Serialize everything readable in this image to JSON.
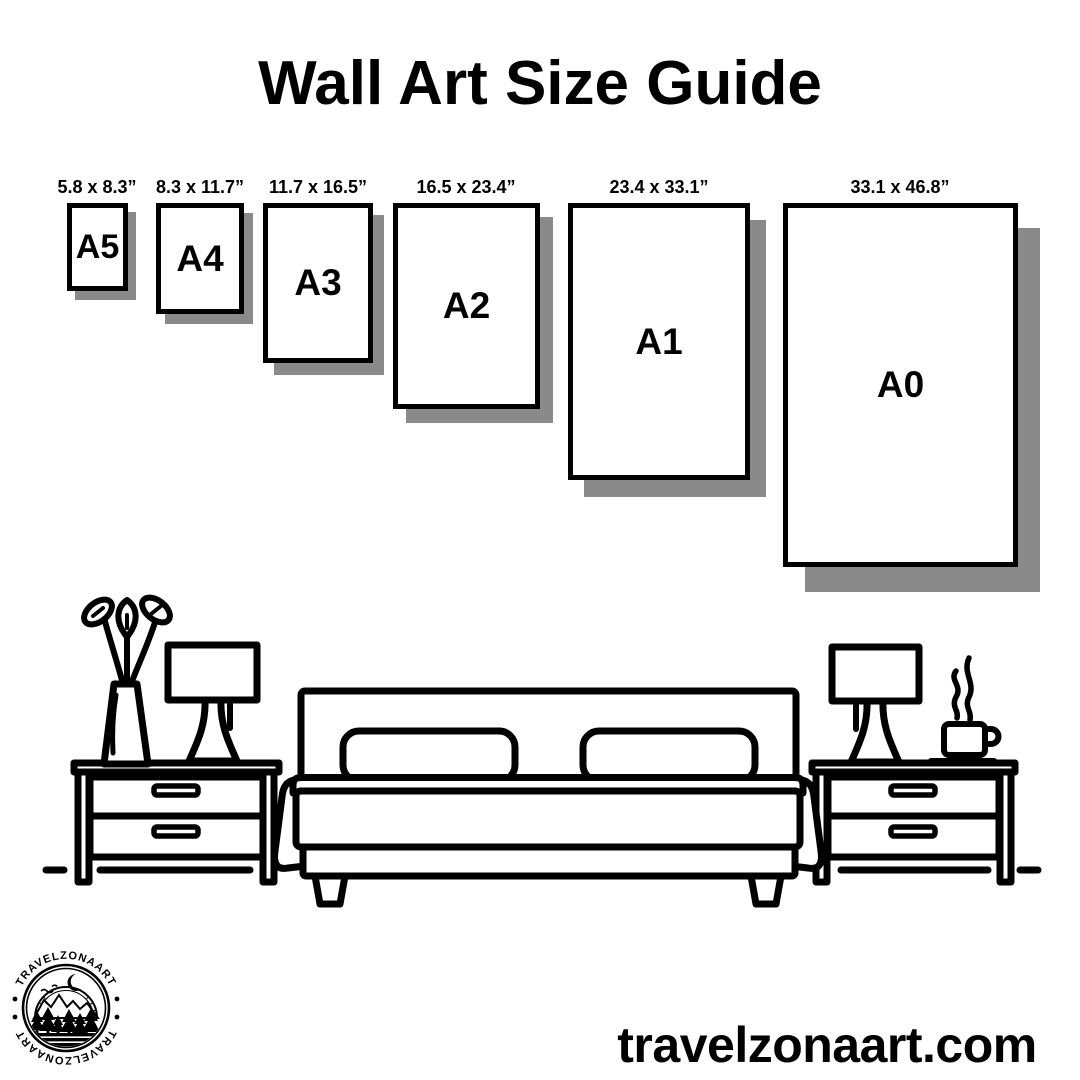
{
  "title": "Wall Art Size Guide",
  "sizes": [
    {
      "code": "A5",
      "dimensions": "5.8 x 8.3”"
    },
    {
      "code": "A4",
      "dimensions": "8.3 x 11.7”"
    },
    {
      "code": "A3",
      "dimensions": "11.7 x 16.5”"
    },
    {
      "code": "A2",
      "dimensions": "16.5 x 23.4”"
    },
    {
      "code": "A1",
      "dimensions": "23.4 x 33.1”"
    },
    {
      "code": "A0",
      "dimensions": "33.1 x 46.8”"
    }
  ],
  "illustration": {
    "items": [
      "flower-vase",
      "table-lamp",
      "nightstand",
      "double-bed",
      "nightstand",
      "table-lamp",
      "coffee-cup"
    ]
  },
  "logo": {
    "arc_text_top": "TRAVELZONAART",
    "arc_text_bottom": "TRAVELZONAART"
  },
  "website": "travelzonaart.com",
  "colors": {
    "ink": "#000000",
    "paper_shadow": "#8a8a8a",
    "background": "#ffffff"
  }
}
